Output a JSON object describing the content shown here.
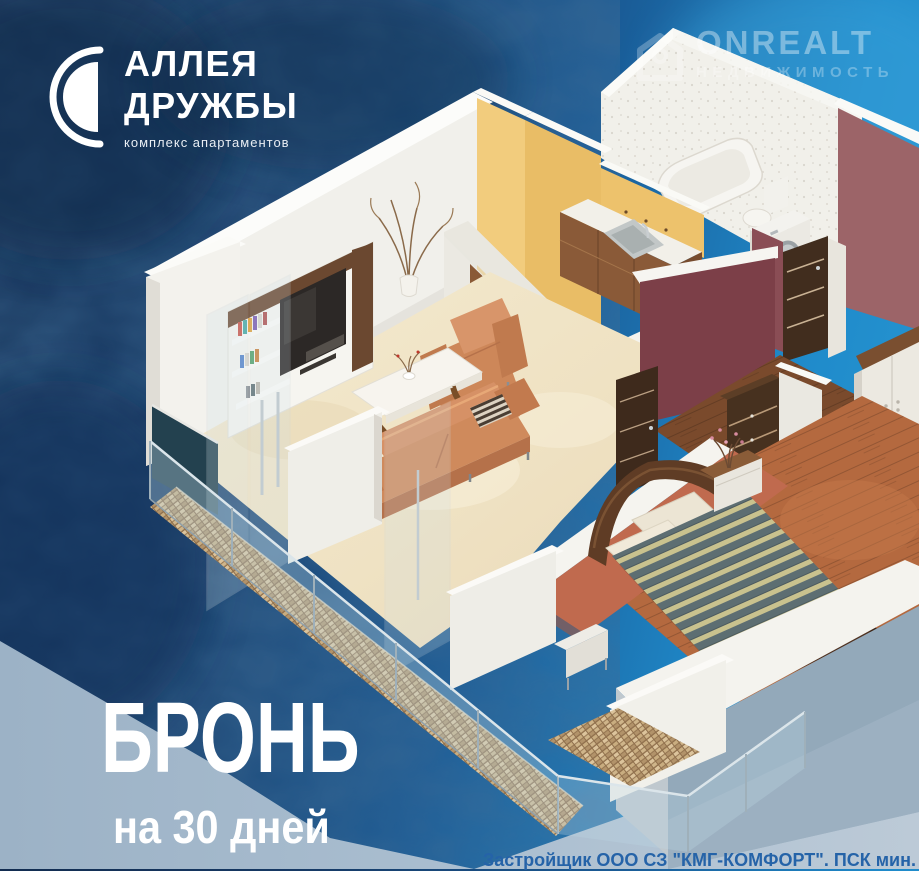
{
  "brand": {
    "line1": "АЛЛЕЯ",
    "line2": "ДРУЖБЫ",
    "tagline": "комплекс апартаментов"
  },
  "watermark": {
    "title": "ONREALT",
    "subtitle": "НЕДВИЖИМОСТЬ"
  },
  "promo": {
    "headline": "БРОНЬ",
    "subline": "на 30 дней"
  },
  "legal": {
    "note": "Застройщик ООО СЗ \"КМГ-КОМФОРТ\". ПСК мин."
  },
  "palette": {
    "background_navy": "#16375f",
    "background_blue": "#1e8cc9",
    "ground_panel": "#a9bdcf",
    "wall_white": "#f2f1ec",
    "accent_yellow": "#eec26e",
    "accent_maroon": "#8c4a52",
    "accent_terracotta": "#c06a4e",
    "wood_cabinet": "#8a5a36",
    "floor_beige": "#f0e4c6",
    "floor_wood": "#b4693f",
    "sofa_orange": "#d28c5e",
    "duvet_teal": "#5d6e72",
    "duvet_cream": "#c9c28e",
    "text_white": "#ffffff",
    "disclaimer_blue": "#2563a8"
  }
}
